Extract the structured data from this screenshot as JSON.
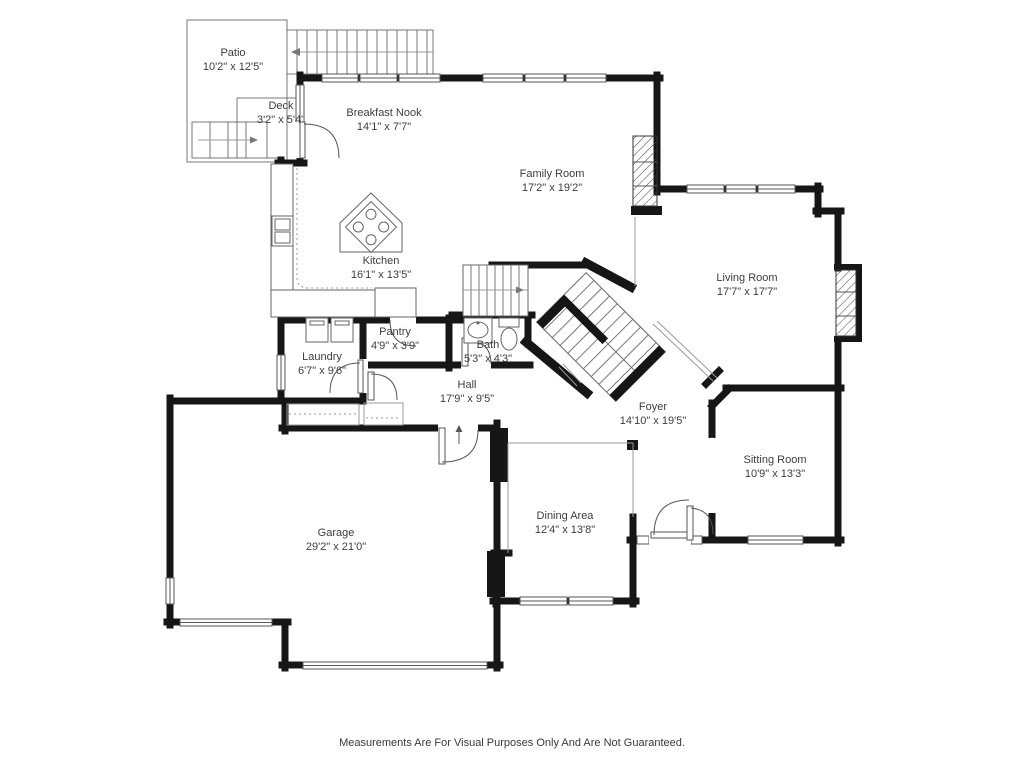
{
  "document": {
    "type": "floor-plan",
    "disclaimer": "Measurements Are For Visual Purposes Only And Are Not Guaranteed."
  },
  "rooms": [
    {
      "name": "Patio",
      "dims": "10'2\" x 12'5\""
    },
    {
      "name": "Deck",
      "dims": "3'2\" x 5'4\""
    },
    {
      "name": "Breakfast Nook",
      "dims": "14'1\" x 7'7\""
    },
    {
      "name": "Family Room",
      "dims": "17'2\" x 19'2\""
    },
    {
      "name": "Kitchen",
      "dims": "16'1\" x 13'5\""
    },
    {
      "name": "Living Room",
      "dims": "17'7\" x 17'7\""
    },
    {
      "name": "Pantry",
      "dims": "4'9\" x 3'9\""
    },
    {
      "name": "Laundry",
      "dims": "6'7\" x 9'6\""
    },
    {
      "name": "Bath",
      "dims": "5'3\" x 4'3\""
    },
    {
      "name": "Hall",
      "dims": "17'9\" x 9'5\""
    },
    {
      "name": "Foyer",
      "dims": "14'10\" x 19'5\""
    },
    {
      "name": "Sitting Room",
      "dims": "10'9\" x 13'3\""
    },
    {
      "name": "Dining Area",
      "dims": "12'4\" x 13'8\""
    },
    {
      "name": "Garage",
      "dims": "29'2\" x 21'0\""
    }
  ],
  "colors": {
    "wall": "#161616",
    "thin_line": "#777777",
    "text": "#3d3d3d",
    "background": "#ffffff"
  }
}
